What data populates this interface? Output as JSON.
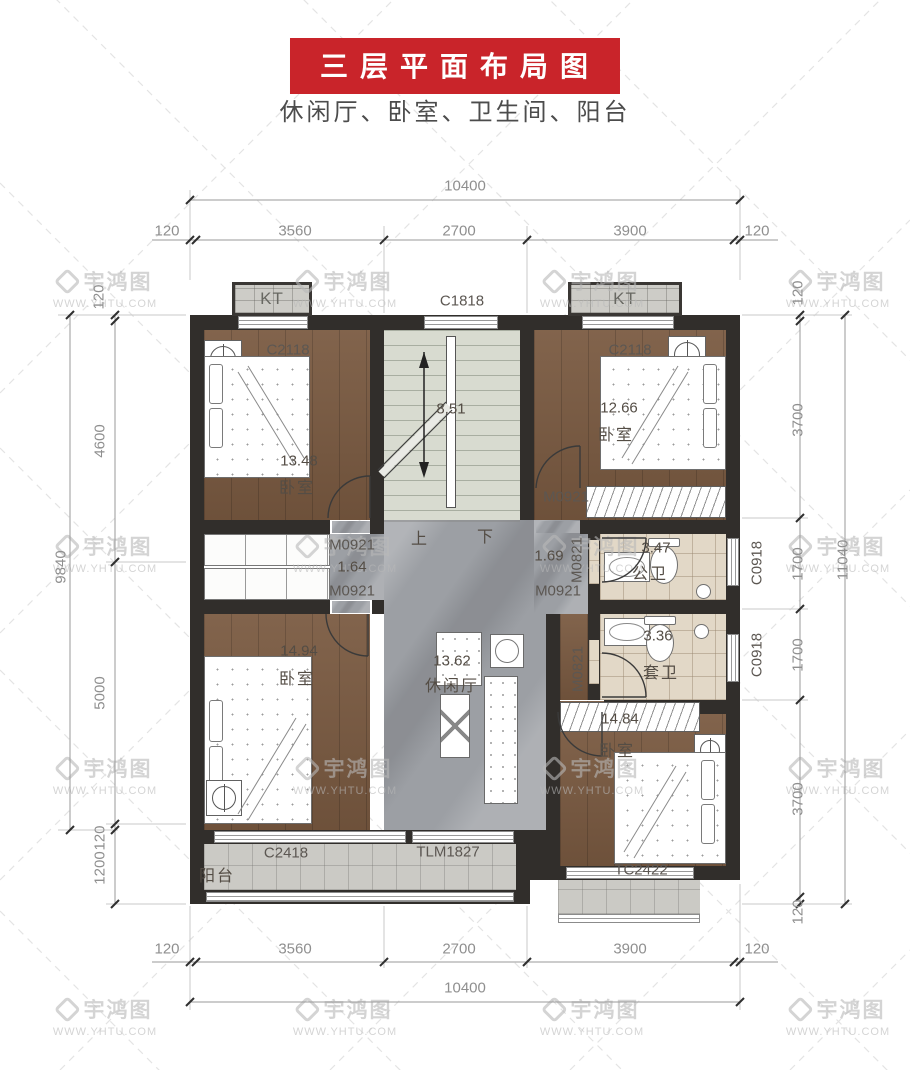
{
  "title": "三层平面布局图",
  "subtitle": "休闲厅、卧室、卫生间、阳台",
  "watermark": {
    "brand": "宇鸿图",
    "url": "WWW.YHTU.COM"
  },
  "colors": {
    "accent_red": "#c9242a",
    "wall": "#312e2b",
    "wood": "#7a5a41",
    "marble": "#9c9fa4",
    "stair": "#d8dbd0",
    "bath_tile": "#e2d8c7",
    "balcony_tile": "#cbcac5"
  },
  "plan": {
    "ac": {
      "label": "KT"
    },
    "windows": {
      "c1818": "C1818"
    },
    "doors": {
      "m0921": "M0921",
      "m0821": "M0821"
    },
    "stairs": {
      "area": "8.51",
      "up": "上",
      "down": "下"
    },
    "rooms": {
      "bedroom_top_left": {
        "name": "卧室",
        "area": "13.48",
        "window": "C2118"
      },
      "bedroom_top_right": {
        "name": "卧室",
        "area": "12.66",
        "window": "C2118"
      },
      "bedroom_bottom_left": {
        "name": "卧室",
        "area": "14.94"
      },
      "bedroom_bottom_right": {
        "name": "卧室",
        "area": "14.84",
        "window": "TC2422"
      },
      "leisure_hall": {
        "name": "休闲厅",
        "area": "13.62"
      },
      "bath_top": {
        "name": "公卫",
        "area": "3.47",
        "window": "C0918"
      },
      "bath_bottom": {
        "name": "套卫",
        "area": "3.36",
        "window": "C0918"
      },
      "balcony": {
        "name": "阳台",
        "window": "C2418",
        "door": "TLM1827"
      },
      "passage_left": {
        "area": "1.64",
        "door_top": "M0921",
        "door_bottom": "M0921"
      },
      "passage_right": {
        "area": "1.69",
        "door": "M0921"
      }
    }
  },
  "dims": {
    "top": {
      "total": "10400",
      "chain": [
        "120",
        "3560",
        "2700",
        "3900",
        "120"
      ]
    },
    "bottom": {
      "total": "10400",
      "chain": [
        "120",
        "3560",
        "2700",
        "3900",
        "120"
      ]
    },
    "left": {
      "total": "9840",
      "chain": [
        "120",
        "4600",
        "5000",
        "120",
        "1200"
      ]
    },
    "right": {
      "total": "11040",
      "chain": [
        "120",
        "3700",
        "1700",
        "1700",
        "3700",
        "120"
      ]
    }
  }
}
